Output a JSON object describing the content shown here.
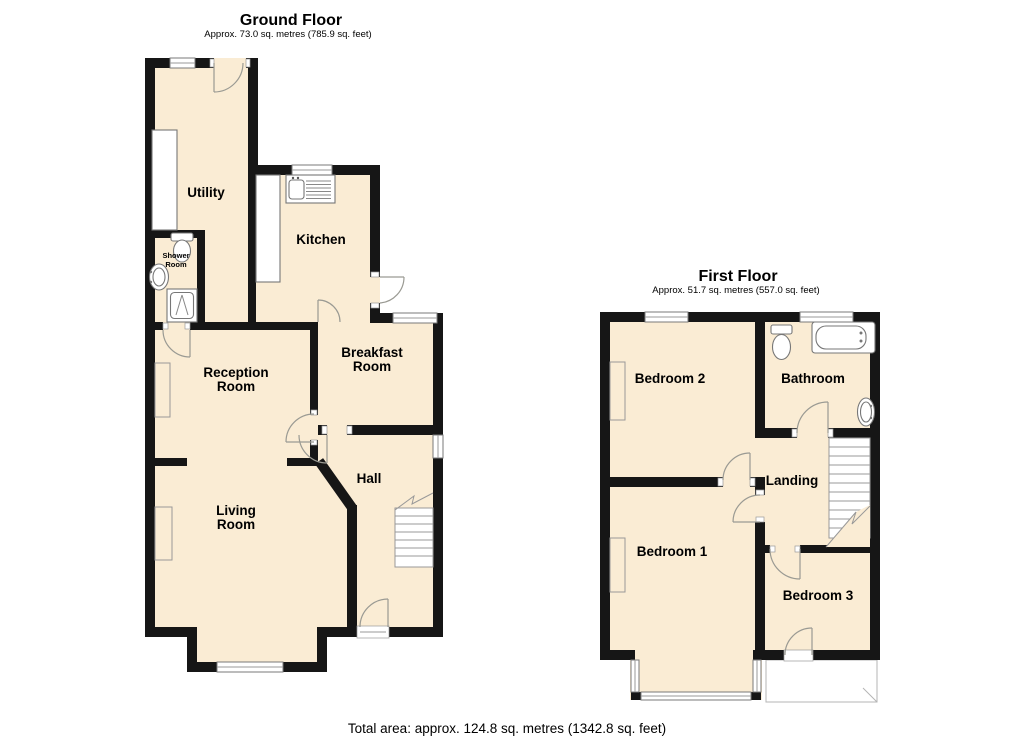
{
  "colors": {
    "floor_fill": "#FAECD4",
    "wall": "#161616",
    "background": "#FFFFFF"
  },
  "ground": {
    "title": "Ground Floor",
    "subtitle": "Approx. 73.0 sq. metres (785.9 sq. feet)",
    "rooms": {
      "utility": "Utility",
      "kitchen": "Kitchen",
      "shower_line1": "Shower",
      "shower_line2": "Room",
      "breakfast_line1": "Breakfast",
      "breakfast_line2": "Room",
      "reception_line1": "Reception",
      "reception_line2": "Room",
      "hall": "Hall",
      "living_line1": "Living",
      "living_line2": "Room"
    }
  },
  "first": {
    "title": "First Floor",
    "subtitle": "Approx. 51.7 sq. metres (557.0 sq. feet)",
    "rooms": {
      "bedroom2": "Bedroom 2",
      "bathroom": "Bathroom",
      "landing": "Landing",
      "bedroom1": "Bedroom 1",
      "bedroom3": "Bedroom 3"
    }
  },
  "footer": {
    "total_area": "Total area: approx. 124.8 sq. metres (1342.8 sq. feet)"
  }
}
